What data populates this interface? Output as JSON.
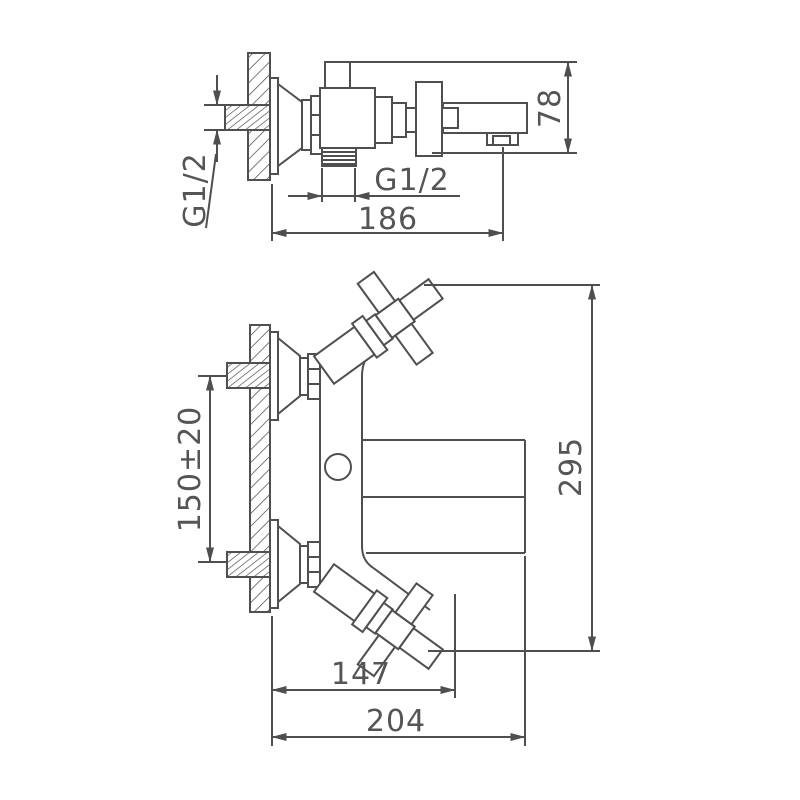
{
  "drawing": {
    "type": "faucet-installation-technical-drawing",
    "colors": {
      "background": "#ffffff",
      "line": "#4f4f4f",
      "text": "#555555"
    },
    "side_view": {
      "inlet_thread_label": "G1/2",
      "body_thread_label": "G1/2",
      "height_dim": "78",
      "wall_to_spout_dim": "186"
    },
    "front_view": {
      "inlet_spacing_dim": "150±20",
      "overall_height_dim": "295",
      "spout_reach_dim": "147",
      "overall_reach_dim": "204"
    }
  }
}
